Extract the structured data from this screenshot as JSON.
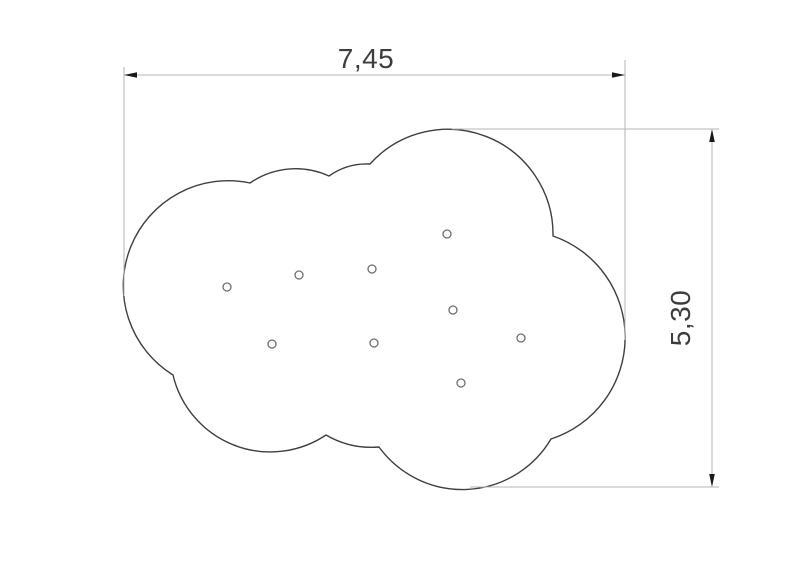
{
  "drawing": {
    "type": "technical-dimension-drawing",
    "background_color": "#ffffff",
    "outline_color": "#3f3f3f",
    "dim_line_color": "#b5b5b5",
    "arrow_color": "#1a1a1a",
    "text_color": "#3d3d3d",
    "hole_stroke_color": "#6e6e6e",
    "cloud": {
      "path": "M 250 183 A 80 80 0 0 1 329 176 A 65 65 0 0 1 370 164 A 105 105 0 0 1 553 236 A 107 107 0 0 1 551 439 A 103 103 0 0 1 379 447 A 90 90 0 0 1 326 435 A 100 100 0 0 1 173 375 A 105 105 0 0 1 250 183 Z"
    },
    "holes": {
      "radius": 4,
      "centers": [
        [
          227,
          287
        ],
        [
          299,
          275
        ],
        [
          372,
          269
        ],
        [
          447,
          234
        ],
        [
          272,
          344
        ],
        [
          374,
          343
        ],
        [
          453,
          310
        ],
        [
          521,
          338
        ],
        [
          461,
          383
        ]
      ]
    },
    "dimensions": {
      "width": {
        "label": "7,45",
        "dim_line": "M 124 75 H 625",
        "ext_line_left": "M 124 67 V 296",
        "ext_line_right": "M 625 60 V 340",
        "arrow_left": "124,75 137,72.2 137,77.8",
        "arrow_right": "625,75 612,72.2 612,77.8"
      },
      "height": {
        "label": "5,30",
        "dim_line": "M 712 131 V 485",
        "ext_line_top": "M 452 129 H 719",
        "ext_line_bottom": "M 470 487 H 719",
        "arrow_top": "712,129 709.2,142 714.8,142",
        "arrow_bottom": "712,487 709.2,474 714.8,474"
      }
    }
  }
}
